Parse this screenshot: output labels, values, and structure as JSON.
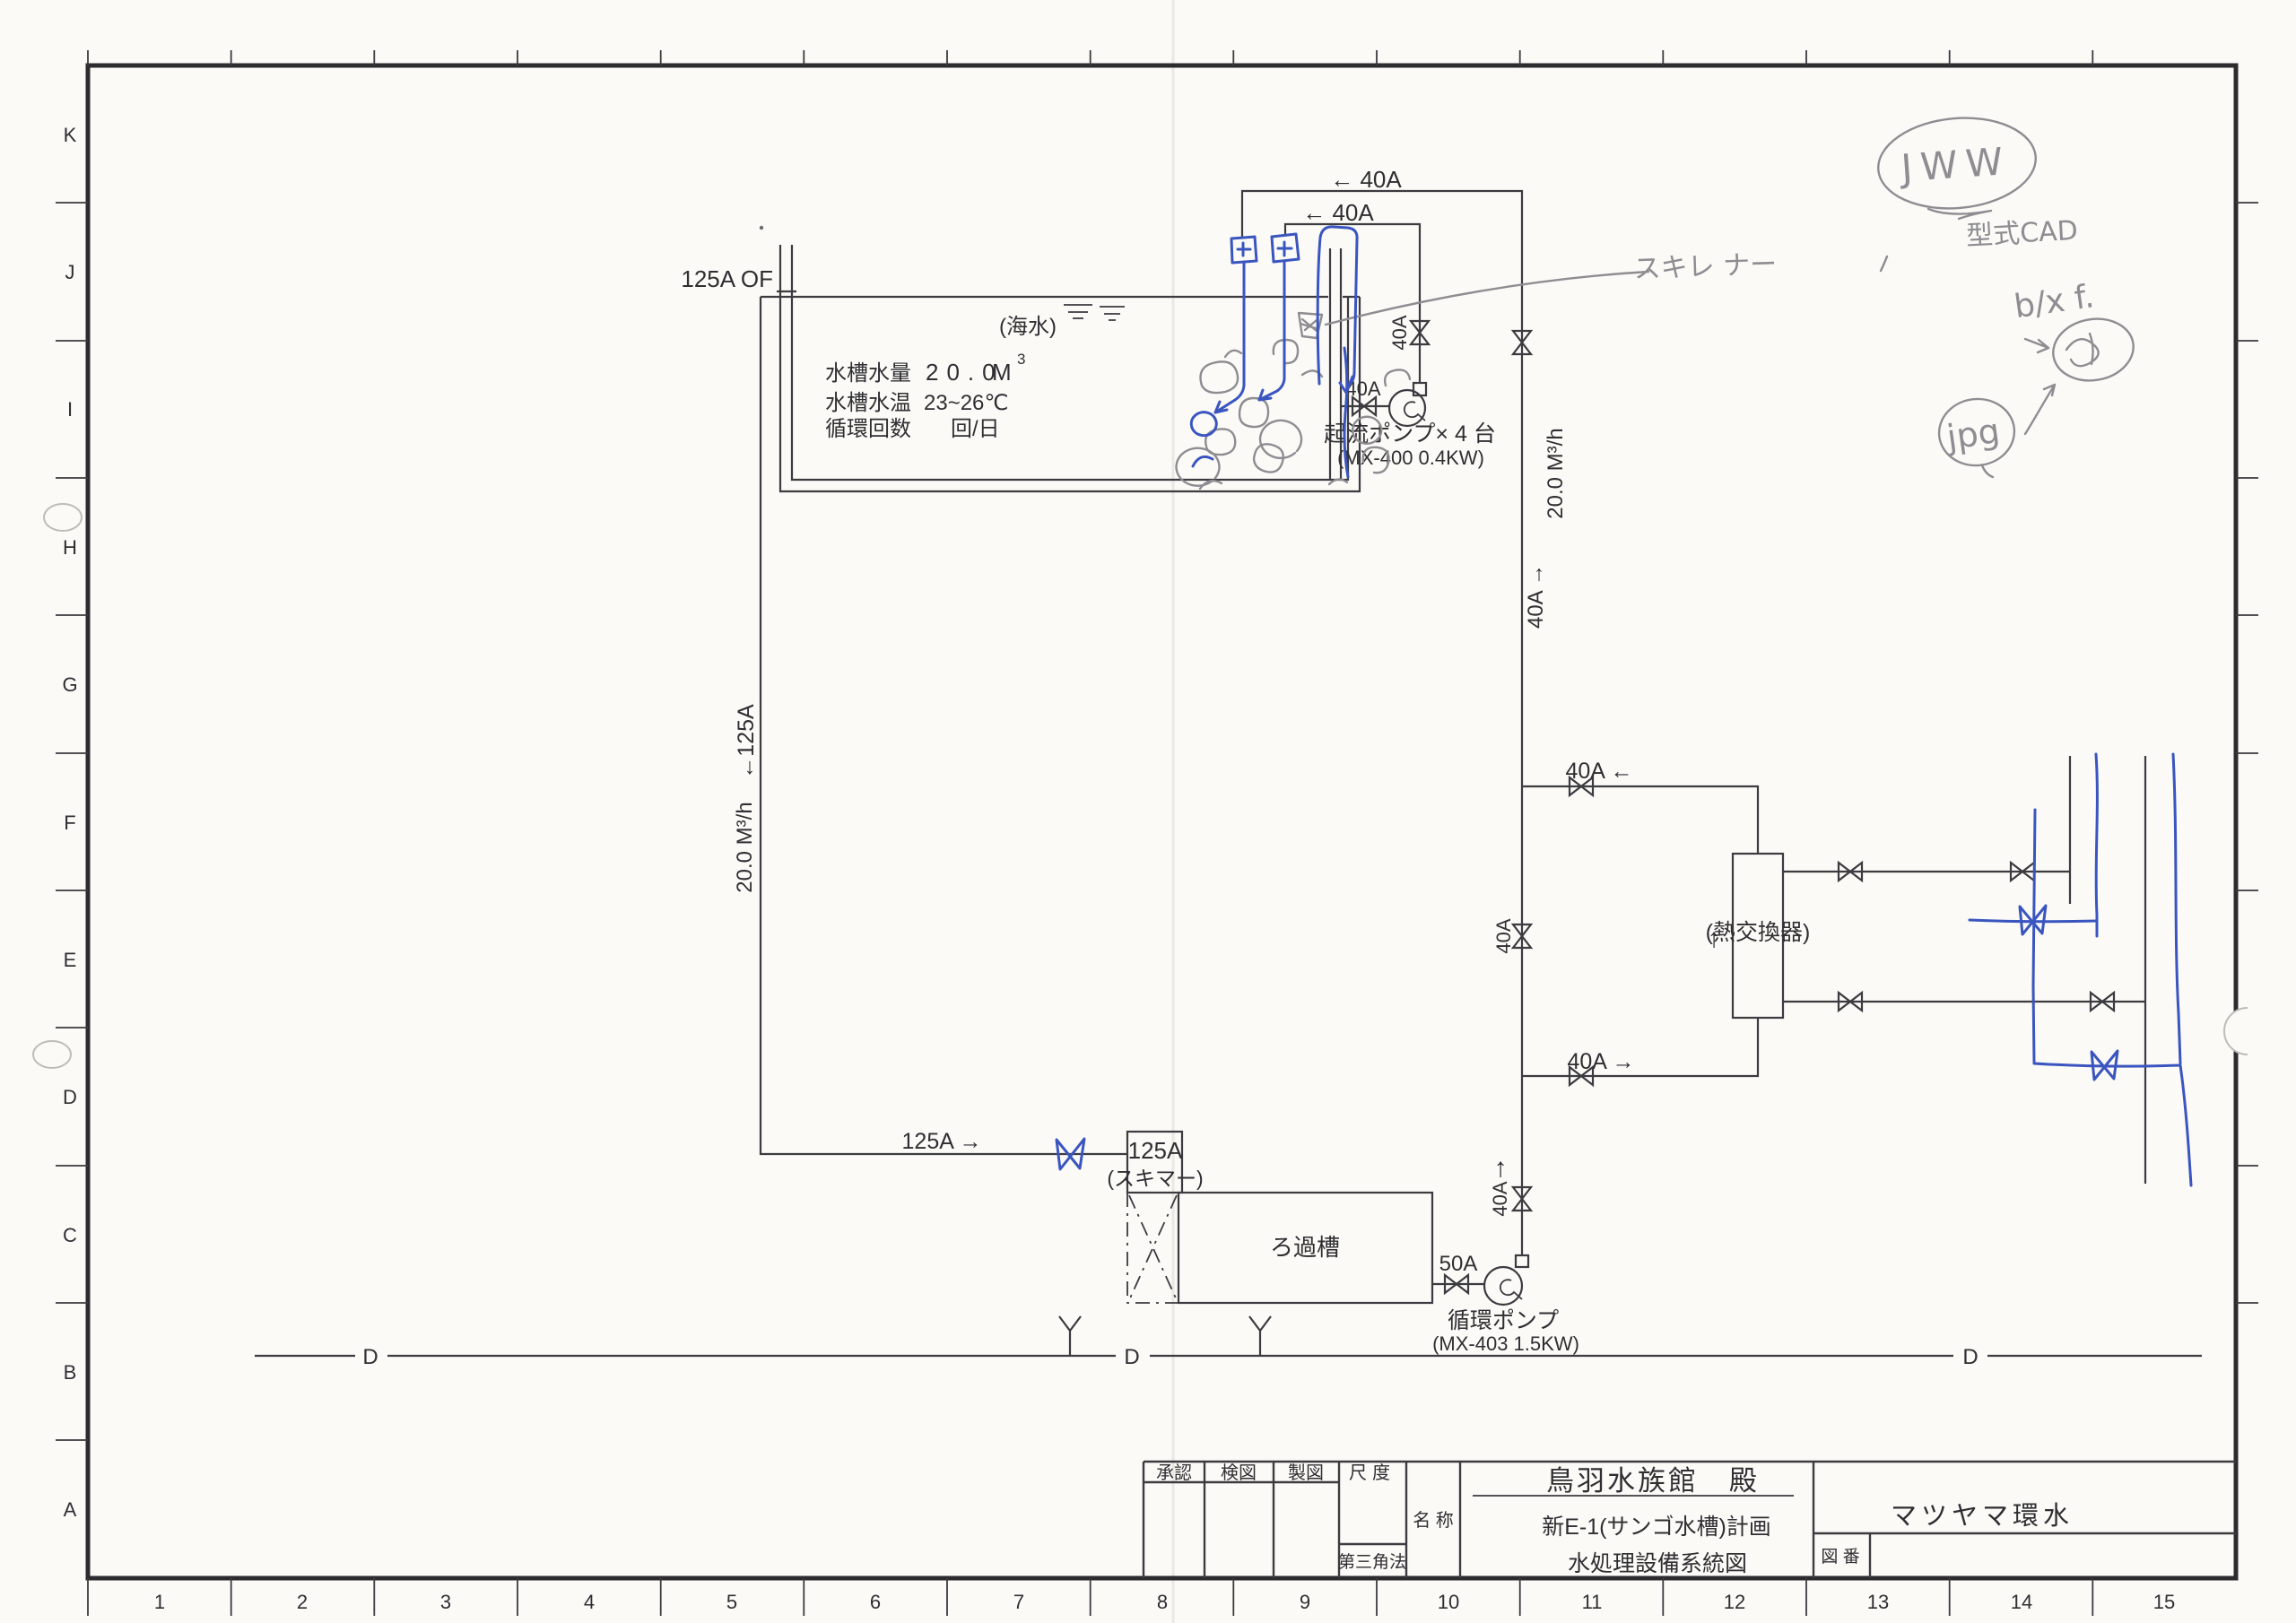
{
  "frame": {
    "letters": [
      "K",
      "J",
      "I",
      "H",
      "G",
      "F",
      "E",
      "D",
      "C",
      "B",
      "A"
    ],
    "numbers": [
      "1",
      "2",
      "3",
      "4",
      "5",
      "6",
      "7",
      "8",
      "9",
      "10",
      "11",
      "12",
      "13",
      "14",
      "15"
    ]
  },
  "tank": {
    "overflow_label": "125A OF",
    "water_note": "(海水)",
    "spec": {
      "r1_label": "水槽水量",
      "r1_value": "20.0",
      "r1_unit": "M",
      "r1_sup": "3",
      "r2_label": "水槽水温",
      "r2_value": "23~26℃",
      "r3_label": "循環回数",
      "r3_value": "回/日"
    }
  },
  "flow_pumps": {
    "loop_outer_label": "← 40A",
    "loop_inner_label": "← 40A",
    "valve_size": "40A",
    "suction_size": "40A",
    "name": "起流ポンプ× 4 台",
    "model": "(MX-400 0.4KW)"
  },
  "riser": {
    "flow": "20.0 M³/h",
    "size_label": "40A →",
    "branch_top": "40A ←",
    "mid_valve_size": "40A",
    "branch_bottom": "40A →",
    "lower_arrow": "↑",
    "lower_valve_size": "40A"
  },
  "heat_exchanger": {
    "name": "(熱交換器)",
    "arrow": "↑"
  },
  "drain": {
    "size": "←125A",
    "flow": "20.0 M³/h",
    "run_label": "125A →"
  },
  "skimmer": {
    "size": "125A",
    "name": "(スキマー)"
  },
  "filter": {
    "name": "ろ過槽",
    "outlet_size": "50A"
  },
  "circ_pump": {
    "name": "循環ポンプ",
    "model": "(MX-403 1.5KW)"
  },
  "datum": {
    "label": "D"
  },
  "title_block": {
    "approve": "承認",
    "check": "検図",
    "draft": "製図",
    "scale": "尺度",
    "projection": "第三角法",
    "name_label": "名  称",
    "client": "鳥羽水族館　殿",
    "project": "新E-1(サンゴ水槽)計画",
    "sheet": "水処理設備系統図",
    "company": "マツヤマ環水",
    "dwg_no_label": "図 番"
  },
  "handwriting": {
    "cad_name": "JWW",
    "cad_note": "型式CAD",
    "note2": "b/x f.",
    "note3": "jpg",
    "skimmer_note": "スキレ ナー"
  }
}
